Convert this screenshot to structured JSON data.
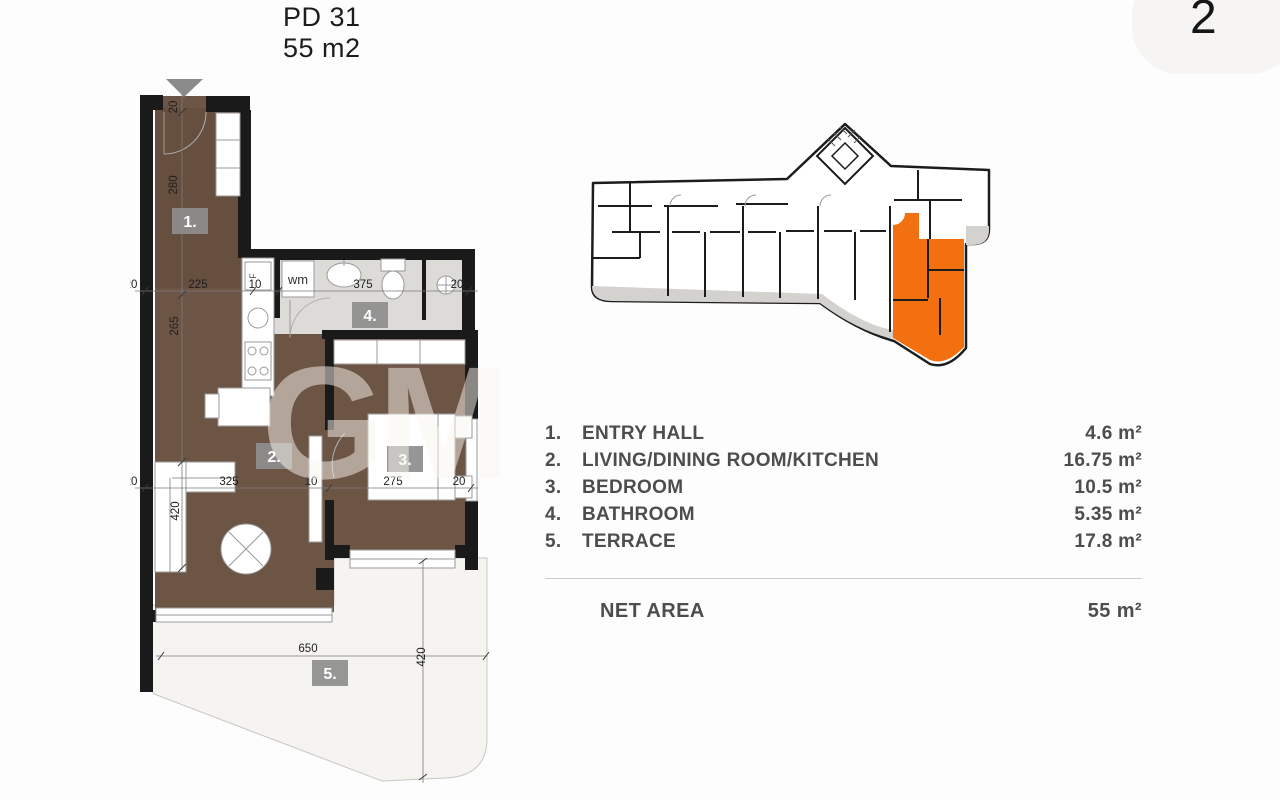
{
  "header": {
    "title_line1": "PD 31",
    "title_line2": "55 m2",
    "page_number": "2"
  },
  "watermark": {
    "text": "GM"
  },
  "floor_plan": {
    "rooms": [
      "1.",
      "2.",
      "3.",
      "4.",
      "5."
    ],
    "fixtures": {
      "washing_machine": "wm",
      "fridge": "F"
    },
    "dim_labels": {
      "top_row": [
        "20",
        "225",
        "10",
        "375",
        "20"
      ],
      "mid_row": [
        "20",
        "325",
        "10",
        "275",
        "20"
      ],
      "left_col": [
        "20",
        "280",
        "265",
        "420"
      ],
      "terrace_width": "650",
      "terrace_depth": "420"
    }
  },
  "colors": {
    "highlight_orange": "#f2700f",
    "floor_brown": "#6d5546",
    "wall_black": "#1a1a1a",
    "terrace_band_gray": "#d3d2cf",
    "bath_tile": "#dcdbd7"
  },
  "legend": {
    "rows": [
      {
        "num": "1.",
        "name": "ENTRY HALL",
        "area": "4.6 m²"
      },
      {
        "num": "2.",
        "name": "LIVING/DINING ROOM/KITCHEN",
        "area": "16.75 m²"
      },
      {
        "num": "3.",
        "name": "BEDROOM",
        "area": "10.5 m²"
      },
      {
        "num": "4.",
        "name": "BATHROOM",
        "area": "5.35 m²"
      },
      {
        "num": "5.",
        "name": "TERRACE",
        "area": "17.8 m²"
      }
    ],
    "net_area_label": "NET AREA",
    "net_area_value": "55 m²"
  }
}
